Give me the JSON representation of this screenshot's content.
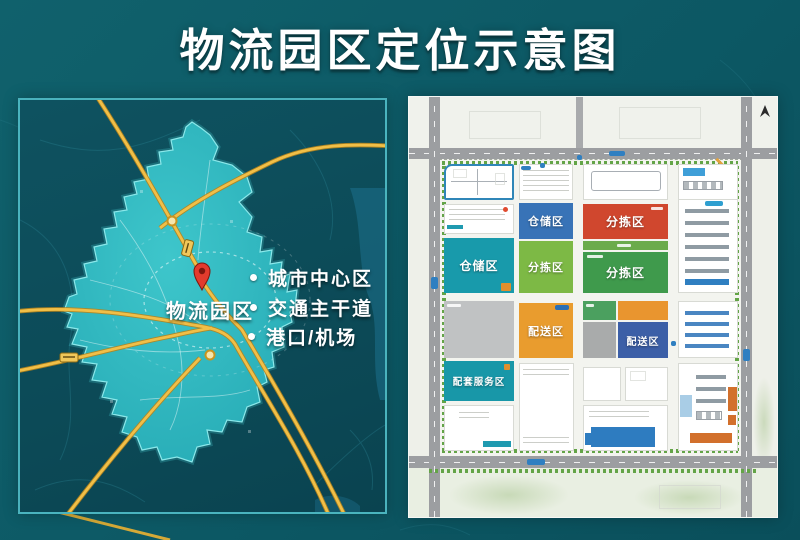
{
  "title": "物流园区定位示意图",
  "left_map": {
    "park_label": "物流园区",
    "legend": [
      {
        "label": "城市中心区"
      },
      {
        "label": "交通主干道"
      },
      {
        "label": "港口/机场"
      }
    ],
    "icons": {
      "pin": "location-pin",
      "legend_marker": "white-dot"
    },
    "colors": {
      "region_fill": "#2bb3bd",
      "region_edge": "#8ae8ea",
      "road_yellow": "#f1bf47",
      "pin_red": "#e23b2d",
      "panel_bg": "#0c4a57"
    }
  },
  "site_plan": {
    "icons": {
      "compass": "north-arrow"
    },
    "zones": [
      {
        "id": "warehouse-top",
        "label": "仓储区",
        "color": "#3873b7"
      },
      {
        "id": "sorting-red",
        "label": "分拣区",
        "color": "#d0472e"
      },
      {
        "id": "warehouse-left",
        "label": "仓储区",
        "color": "#189aab"
      },
      {
        "id": "sorting-light",
        "label": "分拣区",
        "color": "#7db945"
      },
      {
        "id": "sorting-dark",
        "label": "分拣区",
        "color": "#3f9a4c"
      },
      {
        "id": "delivery-orange",
        "label": "配送区",
        "color": "#e99c2e"
      },
      {
        "id": "delivery-blue",
        "label": "配送区",
        "color": "#3c5fa7"
      },
      {
        "id": "service",
        "label": "配套服务区",
        "color": "#1897a8"
      }
    ],
    "colors": {
      "road_gray": "#9c9ea1",
      "trees_green": "#63a447",
      "building_blue": "#2e7cc0",
      "building_orange": "#d2702c",
      "plan_bg": "#eef0e9"
    }
  },
  "page": {
    "background": "#0d5a66",
    "title_color": "#ffffff"
  }
}
